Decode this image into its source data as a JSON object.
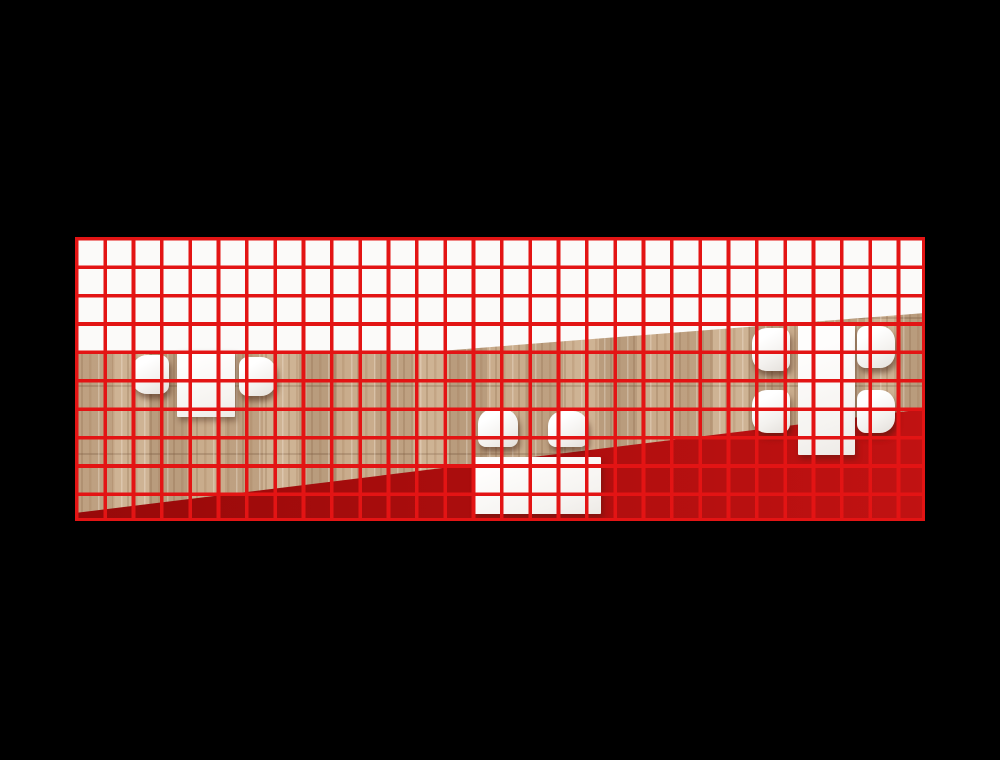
{
  "scene": {
    "label": "Top-down architectural render of a seating area on black background with red analysis grid",
    "background_color": "#000000",
    "width": 1000,
    "height": 760
  },
  "plan": {
    "x": 75,
    "y": 237,
    "width": 850,
    "height": 284,
    "grid": {
      "columns": 30,
      "rows": 10,
      "cell_width": 28.333,
      "cell_height": 28.4,
      "line_width": 3.6,
      "line_color": "#e31414"
    },
    "zones": {
      "white": {
        "color": "#fbfaf9"
      },
      "wood": {
        "base_color": "#c9ac8c",
        "top_edge": {
          "left_y": 114,
          "bend_x": 365,
          "right_y": 76
        }
      },
      "red": {
        "color_left": "#970909",
        "color_right": "#c11212",
        "top_edge": {
          "left_y": 276,
          "right_y": 172
        }
      }
    }
  },
  "furniture": [
    {
      "id": "left-table",
      "type": "table",
      "x": 102,
      "y": 113,
      "w": 58,
      "h": 67
    },
    {
      "id": "left-chair-west",
      "type": "chair",
      "facing": "e",
      "x": 57,
      "y": 118,
      "w": 37,
      "h": 39
    },
    {
      "id": "left-chair-east",
      "type": "chair",
      "facing": "w",
      "x": 164,
      "y": 120,
      "w": 37,
      "h": 39
    },
    {
      "id": "mid-table",
      "type": "table",
      "x": 398,
      "y": 220,
      "w": 128,
      "h": 57
    },
    {
      "id": "mid-chair-west",
      "type": "chair",
      "facing": "s",
      "x": 403,
      "y": 172,
      "w": 40,
      "h": 38
    },
    {
      "id": "mid-chair-east",
      "type": "chair",
      "facing": "s",
      "x": 473,
      "y": 174,
      "w": 40,
      "h": 36
    },
    {
      "id": "right-table",
      "type": "table",
      "x": 723,
      "y": 87,
      "w": 57,
      "h": 131
    },
    {
      "id": "right-chair-nw",
      "type": "chair",
      "facing": "e",
      "x": 677,
      "y": 91,
      "w": 38,
      "h": 43
    },
    {
      "id": "right-chair-sw",
      "type": "chair",
      "facing": "e",
      "x": 677,
      "y": 153,
      "w": 38,
      "h": 43
    },
    {
      "id": "right-chair-ne",
      "type": "chair",
      "facing": "w",
      "x": 782,
      "y": 89,
      "w": 38,
      "h": 42
    },
    {
      "id": "right-chair-se",
      "type": "chair",
      "facing": "w",
      "x": 782,
      "y": 153,
      "w": 38,
      "h": 43
    }
  ]
}
